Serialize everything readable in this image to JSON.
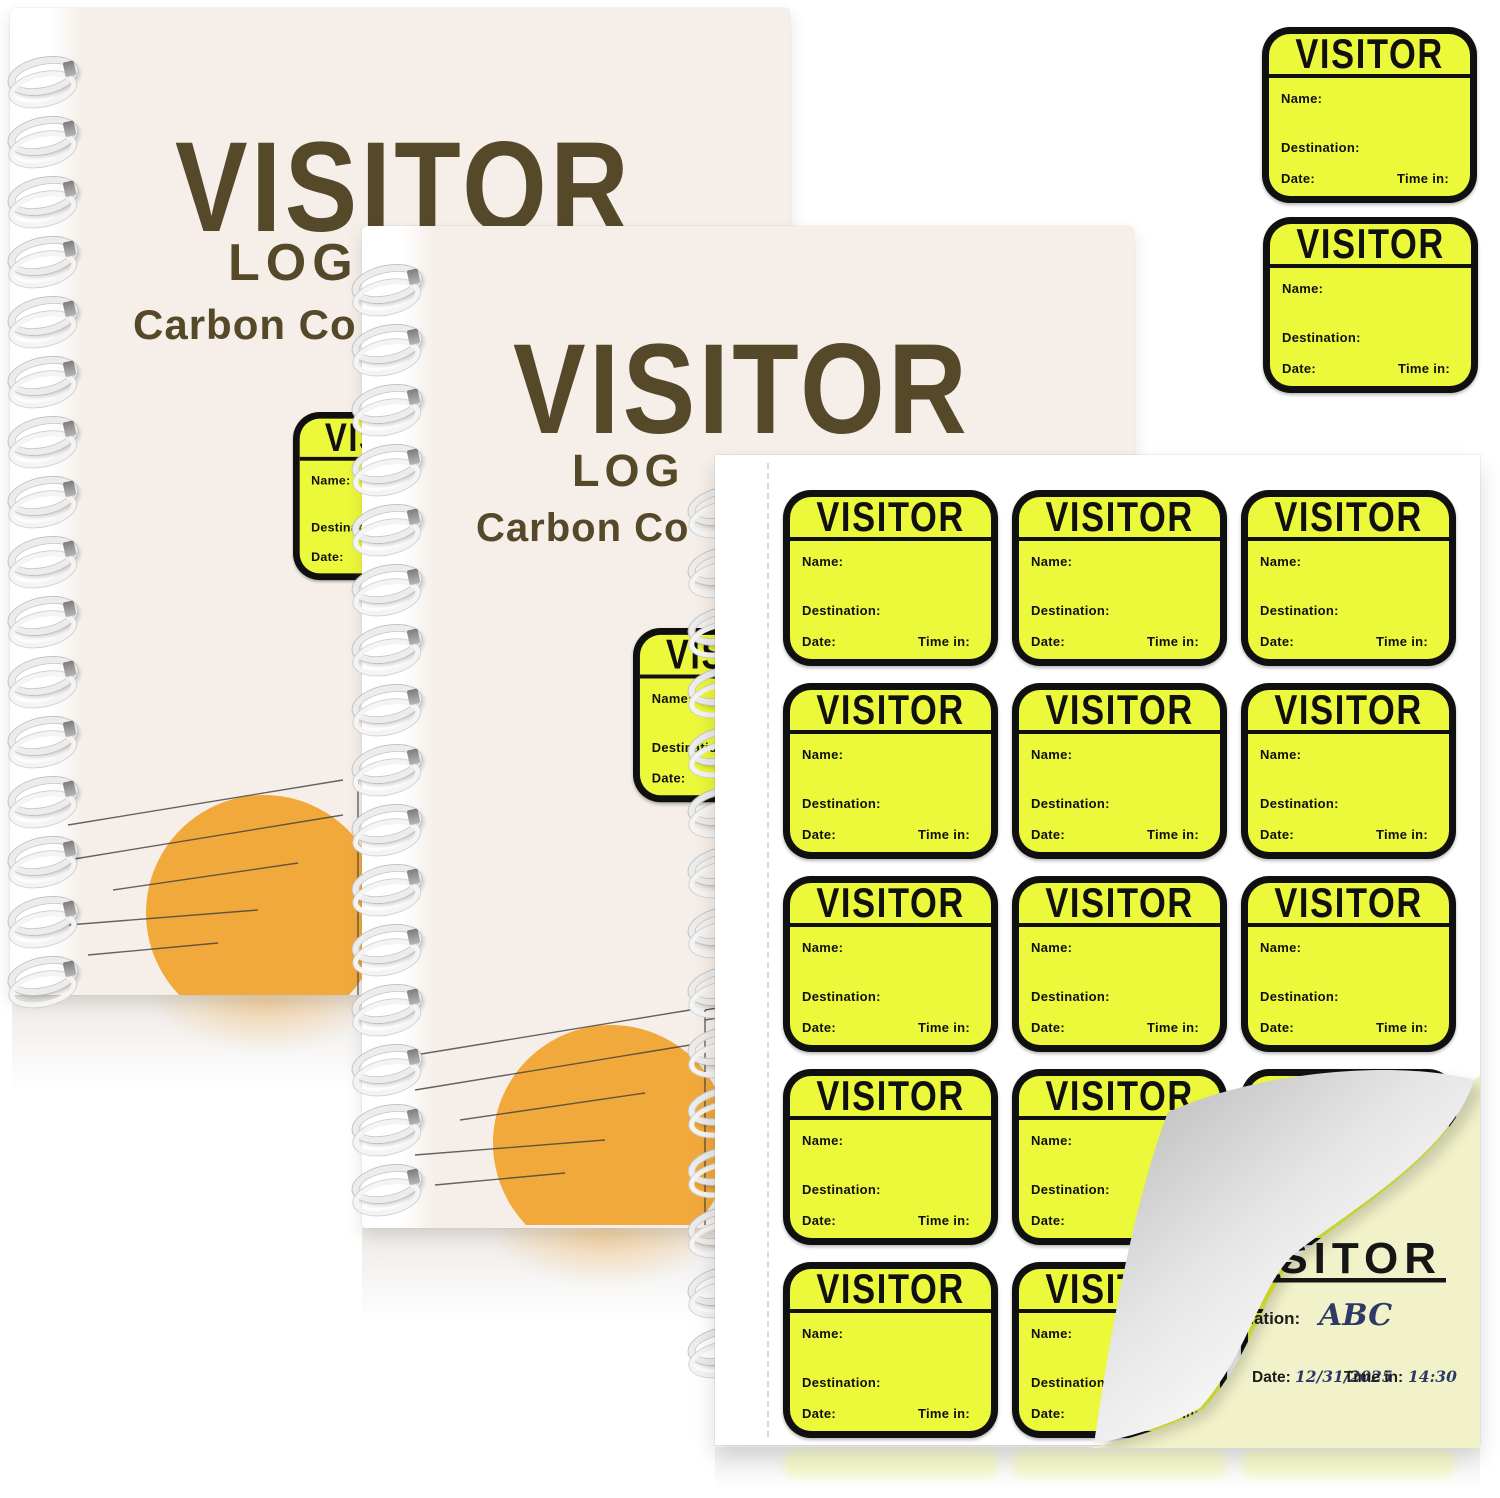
{
  "notebook1": {
    "title": "VISITOR",
    "line2": "LOG",
    "line3": "Carbon Co"
  },
  "notebook2": {
    "title": "VISITOR",
    "line2": "LOG",
    "line3": "Carbon Co"
  },
  "badge": {
    "title": "VISITOR",
    "name_label": "Name:",
    "destination_label": "Destination:",
    "date_label": "Date:",
    "time_in_label": "Time in:"
  },
  "sticker_sheet": {
    "rows": 5,
    "columns": 3
  },
  "carbon_copy": {
    "title": "VISITOR",
    "destination_label": "Destination:",
    "destination_value": "ABC",
    "date_label": "Date:",
    "date_value": "12/31/2025",
    "time_in_label": "Time in:",
    "time_in_value": "14:30"
  },
  "colors": {
    "badge_yellow": "#ecf83a",
    "badge_black": "#101010",
    "cover_ivory": "#f6efe9",
    "title_brown": "#55492a",
    "accent_orange": "#f2a93c",
    "carbon_pale_yellow": "#f1f2c9",
    "handwriting_blue": "#2e3a66"
  }
}
